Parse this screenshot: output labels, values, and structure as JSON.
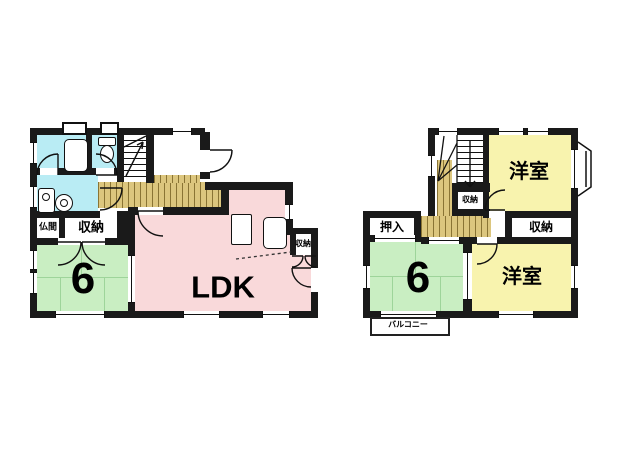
{
  "colors": {
    "wall": "#1a1a1a",
    "water_rooms": "#b9ecf4",
    "ldk_pink": "#f9d9da",
    "tatami_green": "#c9eec2",
    "western_yellow": "#f8f3ae",
    "wood_floor": "#dcc67e"
  },
  "floor1": {
    "labels": {
      "butsuma": "仏間",
      "closet_left": "収納",
      "tatami_size": "6",
      "ldk": "LDK",
      "closet_right": "収納"
    }
  },
  "floor2": {
    "labels": {
      "western_top": "洋室",
      "closet_center": "収納",
      "oshiire": "押入",
      "closet_right": "収納",
      "tatami_size": "6",
      "western_bottom": "洋室",
      "balcony": "バルコニー"
    }
  }
}
